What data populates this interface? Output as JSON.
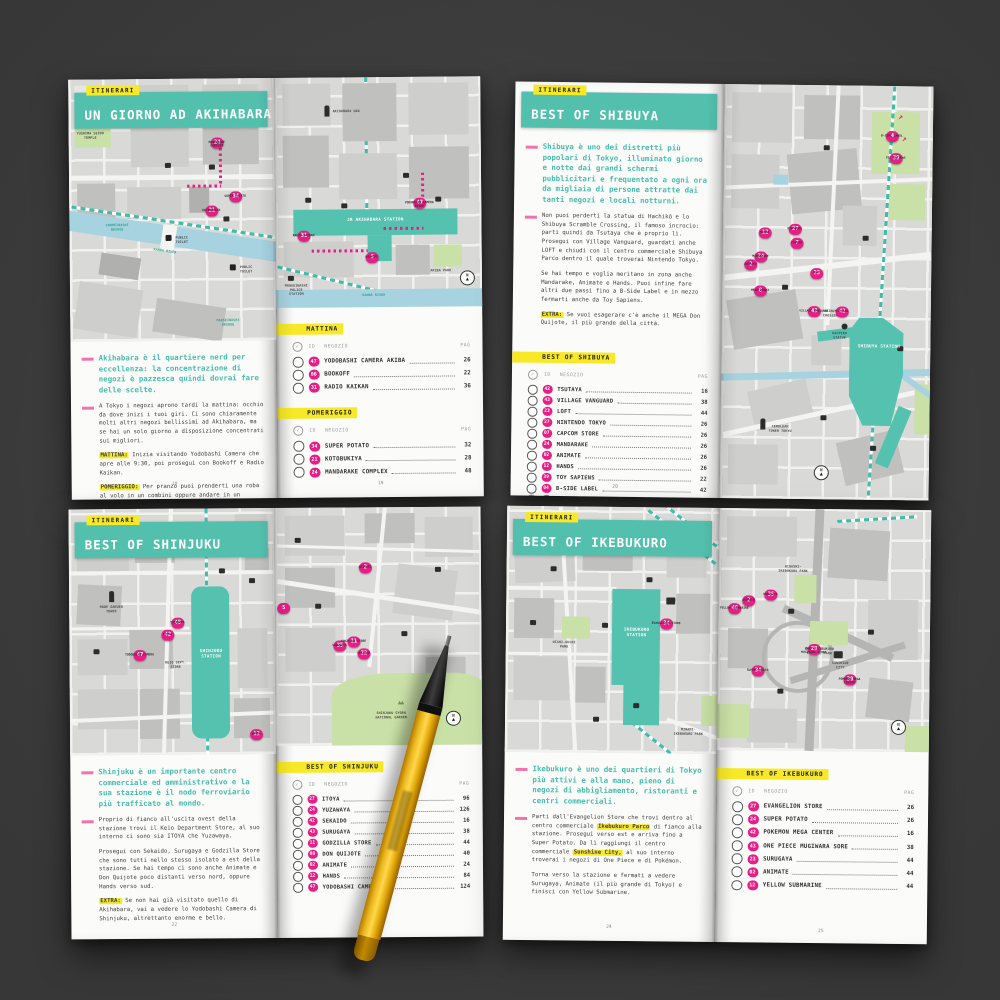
{
  "ui": {
    "check": "✓",
    "compass_n": "N"
  },
  "spreads": [
    {
      "tag": "ITINERARI",
      "title": "UN GIORNO AD AKIHABARA",
      "intro": "Akihabara è il quartiere nerd per eccellenza: la concentrazione di negozi è pazzesca quindi dovrai fare delle scelte.",
      "paragraphs": [
        {
          "label": "",
          "text": "A Tokyo i negozi aprono tardi la mattina: occhio da dove inizi i tuoi giri. Ci sono chiaramente molti altri negozi bellissimi ad Akihabara, ma se hai un solo giorno a disposizione concentrati sui migliori."
        },
        {
          "label": "MATTINA:",
          "text": "Inizia visitando Yodobashi Camera che apre alle 9:30, poi prosegui con Bookoff e Radio Kaikan."
        },
        {
          "label": "POMERIGGIO:",
          "text": "Per pranzo puoi prenderti una roba al volo in un combini oppure andare in un ristorante, come Ootoya. Poi prosegui verso Super Potato, Kotobukiya e chiudi con Mandarake Complex."
        }
      ],
      "page_left": "18",
      "page_right": "19",
      "list_header": {
        "id": "ID",
        "shop": "NEGOZIO",
        "page": "PAG"
      },
      "lists": [
        {
          "heading": "MATTINA",
          "rows": [
            {
              "id": "47",
              "name": "YODOBASHI CAMERA AKIBA",
              "page": "26"
            },
            {
              "id": "06",
              "name": "BOOKOFF",
              "page": "22"
            },
            {
              "id": "31",
              "name": "RADIO KAIKAN",
              "page": "36"
            }
          ]
        },
        {
          "heading": "POMERIGGIO",
          "rows": [
            {
              "id": "34",
              "name": "SUPER POTATO",
              "page": "32"
            },
            {
              "id": "21",
              "name": "KOTOBUKIYA",
              "page": "28"
            },
            {
              "id": "24",
              "name": "MANDARAKE COMPLEX",
              "page": "48"
            }
          ]
        }
      ],
      "map_left": {
        "labels": [
          "YUSHIMA SEIDO TEMPLE",
          "KANDA RIVER",
          "SHOHEIBASHI BRIDGE",
          "PUBLIC TOILET",
          "MANSEIBASHI BRIDGE"
        ],
        "markers": [
          {
            "n": "24",
            "label": "MANDARAKE COMPLEX"
          },
          {
            "n": "34",
            "label": "SUPER POTATO"
          },
          {
            "n": "21",
            "label": "KOTOBUKIYA"
          }
        ]
      },
      "map_right": {
        "labels": [
          "JR AKIHABARA STATION",
          "KANDA RIVER",
          "AKIBA PARK",
          "MANSEIBASHI POLICE STATION",
          "AKIHABARA UDX"
        ],
        "markers": [
          {
            "n": "47",
            "label": "YODOBASHI CAMERA AKIBA"
          },
          {
            "n": "31",
            "label": "RADIO KAIKAN"
          },
          {
            "n": "6",
            "label": "BOOKOFF"
          }
        ]
      }
    },
    {
      "tag": "ITINERARI",
      "title": "BEST OF SHIBUYA",
      "intro": "Shibuya è uno dei distretti più popolari di Tokyo, illuminato giorno e notte dai grandi schermi pubblicitari e frequentato a ogni ora da migliaia di persone attratte dai tanti negozi e locali notturni.",
      "paragraphs": [
        {
          "label": "",
          "text": "Non puoi perderti la statua di Hachikō e lo Shibuya Scramble Crossing, il famoso incrocio: parti quindi da Tsutaya che è proprio lì. Prosegui con Village Vanguard, guardati anche LOFT e chiudi con il centro commerciale Shibuya Parco dentro il quale troverai Nintendo Tokyo."
        },
        {
          "label": "",
          "text": "Se hai tempo e voglia meritano in zona anche Mandarake, Animate e Hands. Puoi infine fare altri due passi fino a B-Side Label e in mezzo fermarti anche da Toy Sapiens."
        },
        {
          "label": "EXTRA:",
          "text": "Se vuoi esagerare c'è anche il MEGA Don Quijote, il più grande della città."
        }
      ],
      "page_left": "20",
      "list_header": {
        "id": "ID",
        "shop": "NEGOZIO",
        "page": "PAG"
      },
      "lists": [
        {
          "heading": "BEST OF SHIBUYA",
          "rows": [
            {
              "id": "42",
              "name": "TSUTAYA",
              "page": "16"
            },
            {
              "id": "43",
              "name": "VILLAGE VANGUARD",
              "page": "38"
            },
            {
              "id": "23",
              "name": "LOFT",
              "page": "44"
            },
            {
              "id": "27",
              "name": "NINTENDO TOKYO",
              "page": "26"
            },
            {
              "id": "07",
              "name": "CAPCOM STORE",
              "page": "26"
            },
            {
              "id": "24",
              "name": "MANDARAKE",
              "page": "26"
            },
            {
              "id": "02",
              "name": "ANIMATE",
              "page": "26"
            },
            {
              "id": "12",
              "name": "HANDS",
              "page": "26"
            },
            {
              "id": "39",
              "name": "TOY SAPIENS",
              "page": "22"
            },
            {
              "id": "04",
              "name": "B-SIDE LABEL",
              "page": "42"
            },
            {
              "id": "08",
              "name": "MEGA DON QUIJOTE",
              "page": "42"
            }
          ]
        }
      ],
      "map_right": {
        "labels": [
          "SHIBUYA STATION",
          "SHIBUYA CROSSING",
          "HACHIKO STATUE",
          "CERULEAN TOWER TOKYU"
        ],
        "markers": [
          {
            "n": "4",
            "label": "B-SIDE LABEL"
          },
          {
            "n": "39",
            "label": "TOY SAPIENS"
          },
          {
            "n": "12",
            "label": "HANDS"
          },
          {
            "n": "27",
            "label": "NINTENDO"
          },
          {
            "n": "7",
            "label": "CAPCOM"
          },
          {
            "n": "24",
            "label": "MANDARAKE"
          },
          {
            "n": "2",
            "label": "ANIMATE"
          },
          {
            "n": "23",
            "label": "LOFT"
          },
          {
            "n": "8",
            "label": "MEGA DONKI"
          },
          {
            "n": "43",
            "label": "VILLAGE VANGUARD"
          },
          {
            "n": "42",
            "label": "TSUTAYA"
          }
        ]
      }
    },
    {
      "tag": "ITINERARI",
      "title": "BEST OF SHINJUKU",
      "intro": "Shinjuku è un importante centro commerciale ed amministrativo e la sua stazione è il nodo ferroviario più trafficato al mondo.",
      "paragraphs": [
        {
          "label": "",
          "text": "Proprio di fianco all'uscita ovest della stazione trovi il Keio Department Store, al suo interno ci sono sia ITOYA che Yuzawaya."
        },
        {
          "label": "",
          "text": "Prosegui con Sekaido, Surugaya e Godzilla Store che sono tutti nello stesso isolato a est della stazione. Se hai tempo ci sono anche Animate e Don Quijote poco distanti verso nord, oppure Hands verso sud."
        },
        {
          "label": "EXTRA:",
          "text": "Se non hai già visitato quello di Akihabara, vai a vedere lo Yodobashi Camera di Shinjuku, altrettanto enorme e bello."
        }
      ],
      "page_left": "22",
      "list_header": {
        "id": "ID",
        "shop": "NEGOZIO",
        "page": "PAG"
      },
      "lists": [
        {
          "heading": "BEST OF SHINJUKU",
          "rows": [
            {
              "id": "27",
              "name": "ITOYA",
              "page": "96"
            },
            {
              "id": "24",
              "name": "YUZAWAYA",
              "page": "126"
            },
            {
              "id": "42",
              "name": "SEKAIDO",
              "page": "16"
            },
            {
              "id": "43",
              "name": "SURUGAYA",
              "page": "38"
            },
            {
              "id": "11",
              "name": "GODZILLA STORE",
              "page": "44"
            },
            {
              "id": "08",
              "name": "DON QUIJOTE",
              "page": "40"
            },
            {
              "id": "02",
              "name": "ANIMATE",
              "page": "24"
            },
            {
              "id": "12",
              "name": "HANDS",
              "page": "84"
            },
            {
              "id": "47",
              "name": "YODOBASHI CAMERA",
              "page": "124"
            }
          ]
        }
      ],
      "map_left": {
        "labels": [
          "SHINJUKU STATION",
          "MODE GAKUEN TOWER",
          "KEIO DEPT. STORE"
        ],
        "markers": [
          {
            "n": "8",
            "label": "DONKI"
          },
          {
            "n": "48",
            "label": "YUZAWAYA"
          },
          {
            "n": "42",
            "label": "ITOYA"
          },
          {
            "n": "47",
            "label": "YODOBASHI CAMERA"
          },
          {
            "n": "12",
            "label": "HANDS"
          }
        ]
      },
      "map_right": {
        "labels": [
          "SHINJUKU GYOEN NATIONAL GARDEN"
        ],
        "markers": [
          {
            "n": "2",
            "label": "ANIMATE"
          },
          {
            "n": "5",
            "label": ""
          },
          {
            "n": "35",
            "label": "SURUGAYA"
          },
          {
            "n": "11",
            "label": "GODZILLA STORE"
          },
          {
            "n": "32",
            "label": "SEKAIDO"
          }
        ]
      }
    },
    {
      "tag": "ITINERARI",
      "title": "BEST OF IKEBUKURO",
      "intro": "Ikebukuro è uno dei quartieri di Tokyo più attivi e alla mano, pieno di negozi di abbigliamento, ristoranti e centri commerciali.",
      "p1_segments": [
        {
          "t": "Parti dall'Evangelion Store che trovi dentro al centro commerciale "
        },
        {
          "t": "Ikebukuro Parco"
        },
        {
          "t": " di fianco alla stazione. Prosegui verso est e arriva fino a Super Potato. Da lì raggiungi il centro commerciale "
        },
        {
          "t": "Sunshine City,"
        },
        {
          "t": " al suo interno troverai i negozi di One Piece e di Pokémon."
        }
      ],
      "paragraphs": [
        {
          "label": "",
          "text": "Torna verso la stazione e fermati a vedere Surugaya, Animate (il più grande di Tokyo) e finisci con Yellow Submarine."
        }
      ],
      "page_left": "24",
      "page_right": "25",
      "list_header": {
        "id": "ID",
        "shop": "NEGOZIO",
        "page": "PAG"
      },
      "lists": [
        {
          "heading": "BEST OF IKEBUKURO",
          "rows": [
            {
              "id": "27",
              "name": "EVANGELION STORE",
              "page": "26"
            },
            {
              "id": "24",
              "name": "SUPER POTATO",
              "page": "26"
            },
            {
              "id": "42",
              "name": "POKEMON MEGA CENTER",
              "page": "16"
            },
            {
              "id": "43",
              "name": "ONE PIECE MUGIWARA SORE",
              "page": "38"
            },
            {
              "id": "23",
              "name": "SURUGAYA",
              "page": "44"
            },
            {
              "id": "02",
              "name": "ANIMATE",
              "page": "44"
            },
            {
              "id": "12",
              "name": "YELLOW SUBMARINE",
              "page": "44"
            }
          ]
        }
      ],
      "map_left": {
        "labels": [
          "IKEBUKURO STATION",
          "NISHI-GUCHI PARK",
          "MINAMI-IKEBUKURO PARK"
        ],
        "markers": [
          {
            "n": "34",
            "label": "EVANGELION STORE"
          }
        ]
      },
      "map_right": {
        "labels": [
          "HIGASHI-IKEBUKURO PARK",
          "EAST-IKEBUKURO CENTRAL PARK",
          "SUNSHINE CITY"
        ],
        "markers": [
          {
            "n": "46",
            "label": "YELLOW SUBMARINE"
          },
          {
            "n": "2",
            "label": "ANIMATE"
          },
          {
            "n": "35",
            "label": "SURUGAYA"
          },
          {
            "n": "34",
            "label": "SUPER POTATO"
          },
          {
            "n": "29",
            "label": "ONE PIECE MUGIWARA STORE"
          },
          {
            "n": "30",
            "label": "POKEMON MEGA CENTER"
          }
        ]
      }
    }
  ]
}
